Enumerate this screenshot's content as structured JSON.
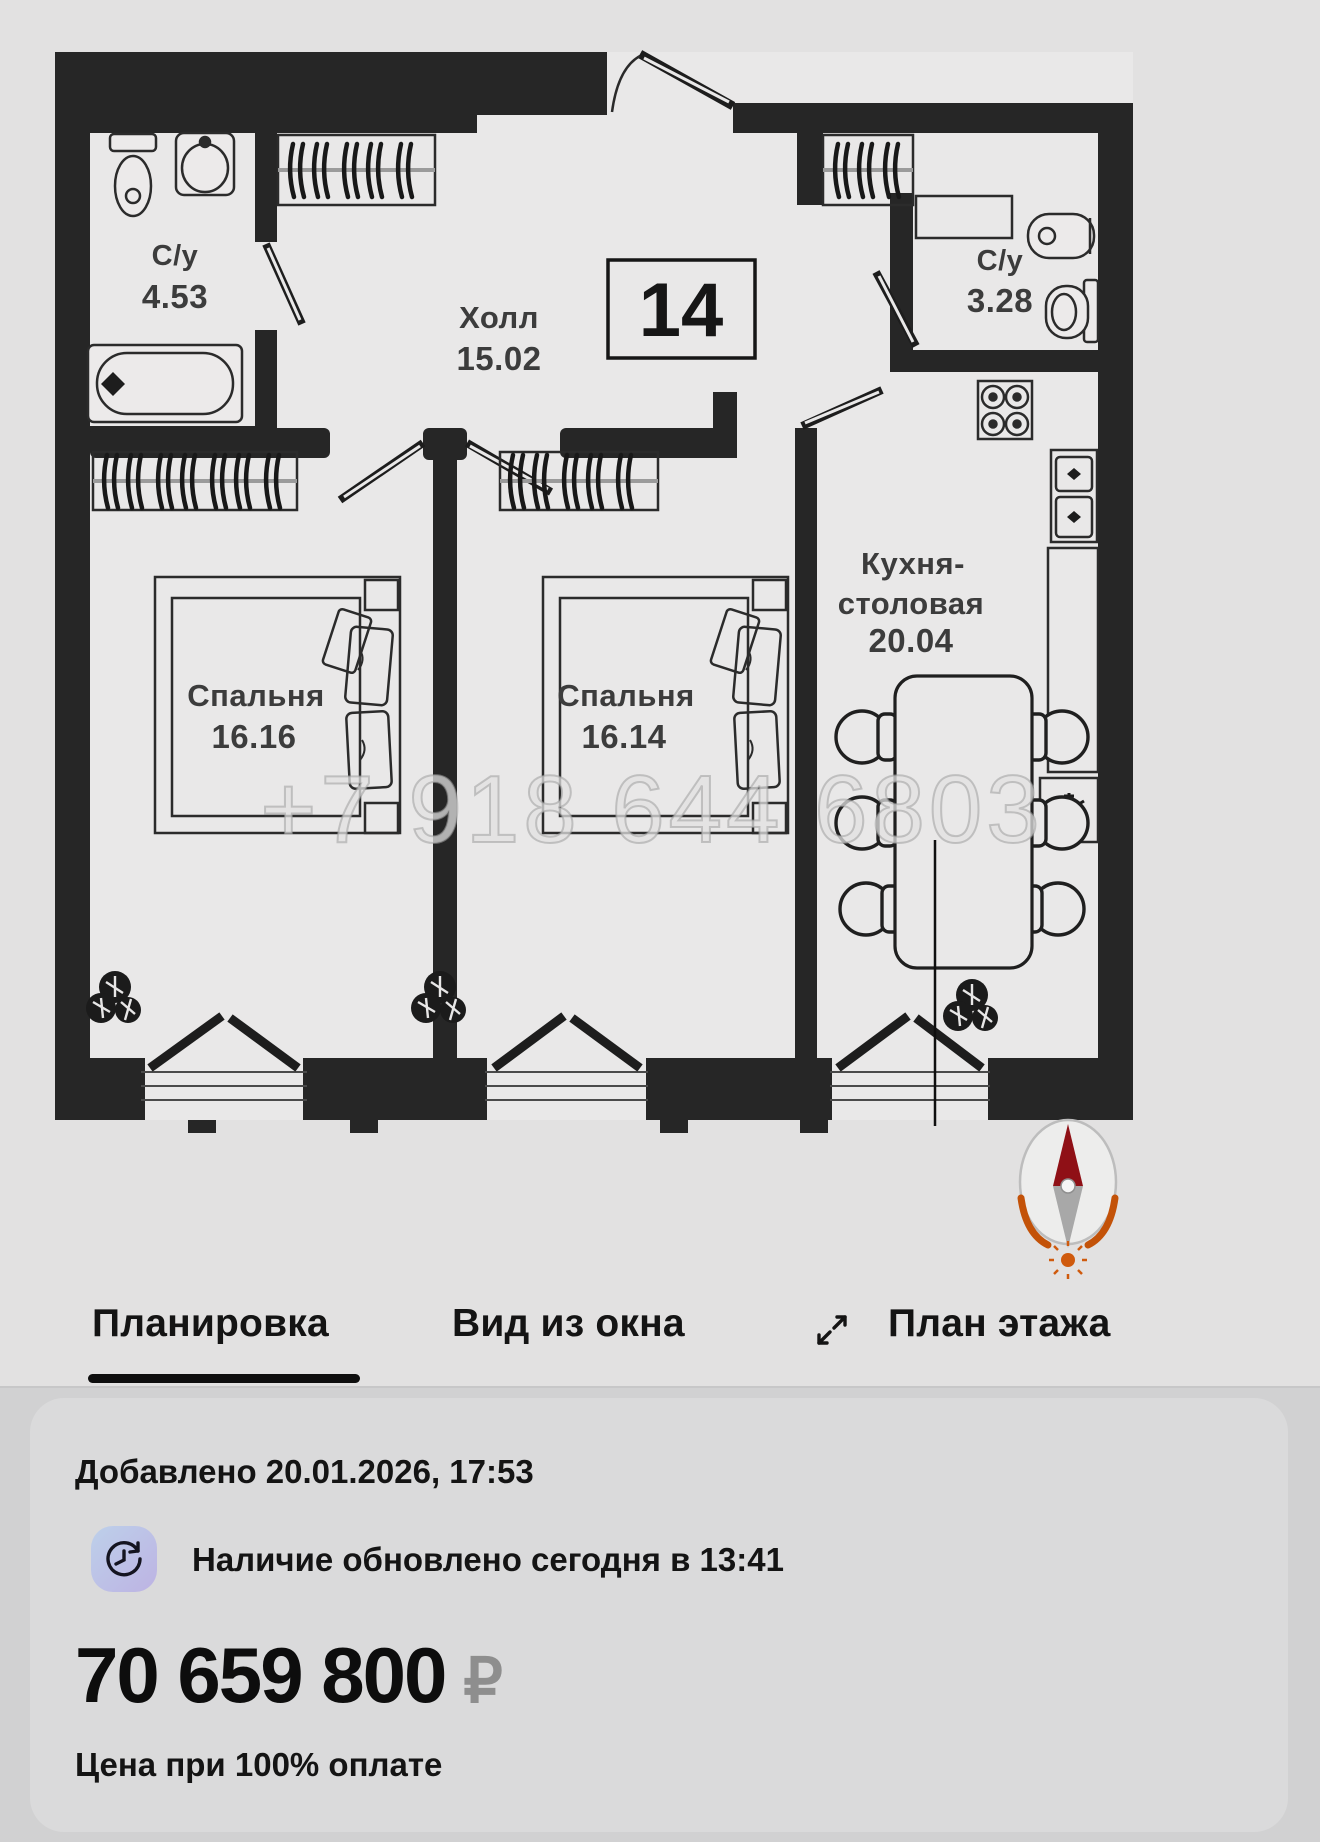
{
  "floorplan": {
    "unit_number": "14",
    "watermark": "+7 918 644 6803",
    "rooms": [
      {
        "name": "С/у",
        "area": "4.53"
      },
      {
        "name": "Холл",
        "area": "15.02"
      },
      {
        "name": "С/у",
        "area": "3.28"
      },
      {
        "name": "Спальня",
        "area": "16.16"
      },
      {
        "name": "Спальня",
        "area": "16.14"
      },
      {
        "name_line1": "Кухня-",
        "name_line2": "столовая",
        "area": "20.04"
      }
    ]
  },
  "tabs": {
    "items": [
      {
        "label": "Планировка",
        "active": true
      },
      {
        "label": "Вид из окна",
        "active": false
      },
      {
        "label": "План этажа",
        "active": false
      }
    ]
  },
  "info_card": {
    "added": "Добавлено 20.01.2026, 17:53",
    "availability": "Наличие обновлено сегодня в 13:41",
    "price": "70 659 800",
    "currency": "₽",
    "price_note": "Цена при 100% оплате"
  },
  "colors": {
    "wall": "#262626",
    "page_bg": "#e2e1e1",
    "bottom_bg": "#d1d1d2",
    "card_bg": "#dadadb",
    "tab_underline": "#0e0e0e",
    "compass_red": "#8f1016",
    "compass_orange": "#c35208",
    "icon_gradient_start": "#bdd0ea",
    "icon_gradient_end": "#bdb3e3",
    "ruble_gray": "#8e8e8e"
  }
}
